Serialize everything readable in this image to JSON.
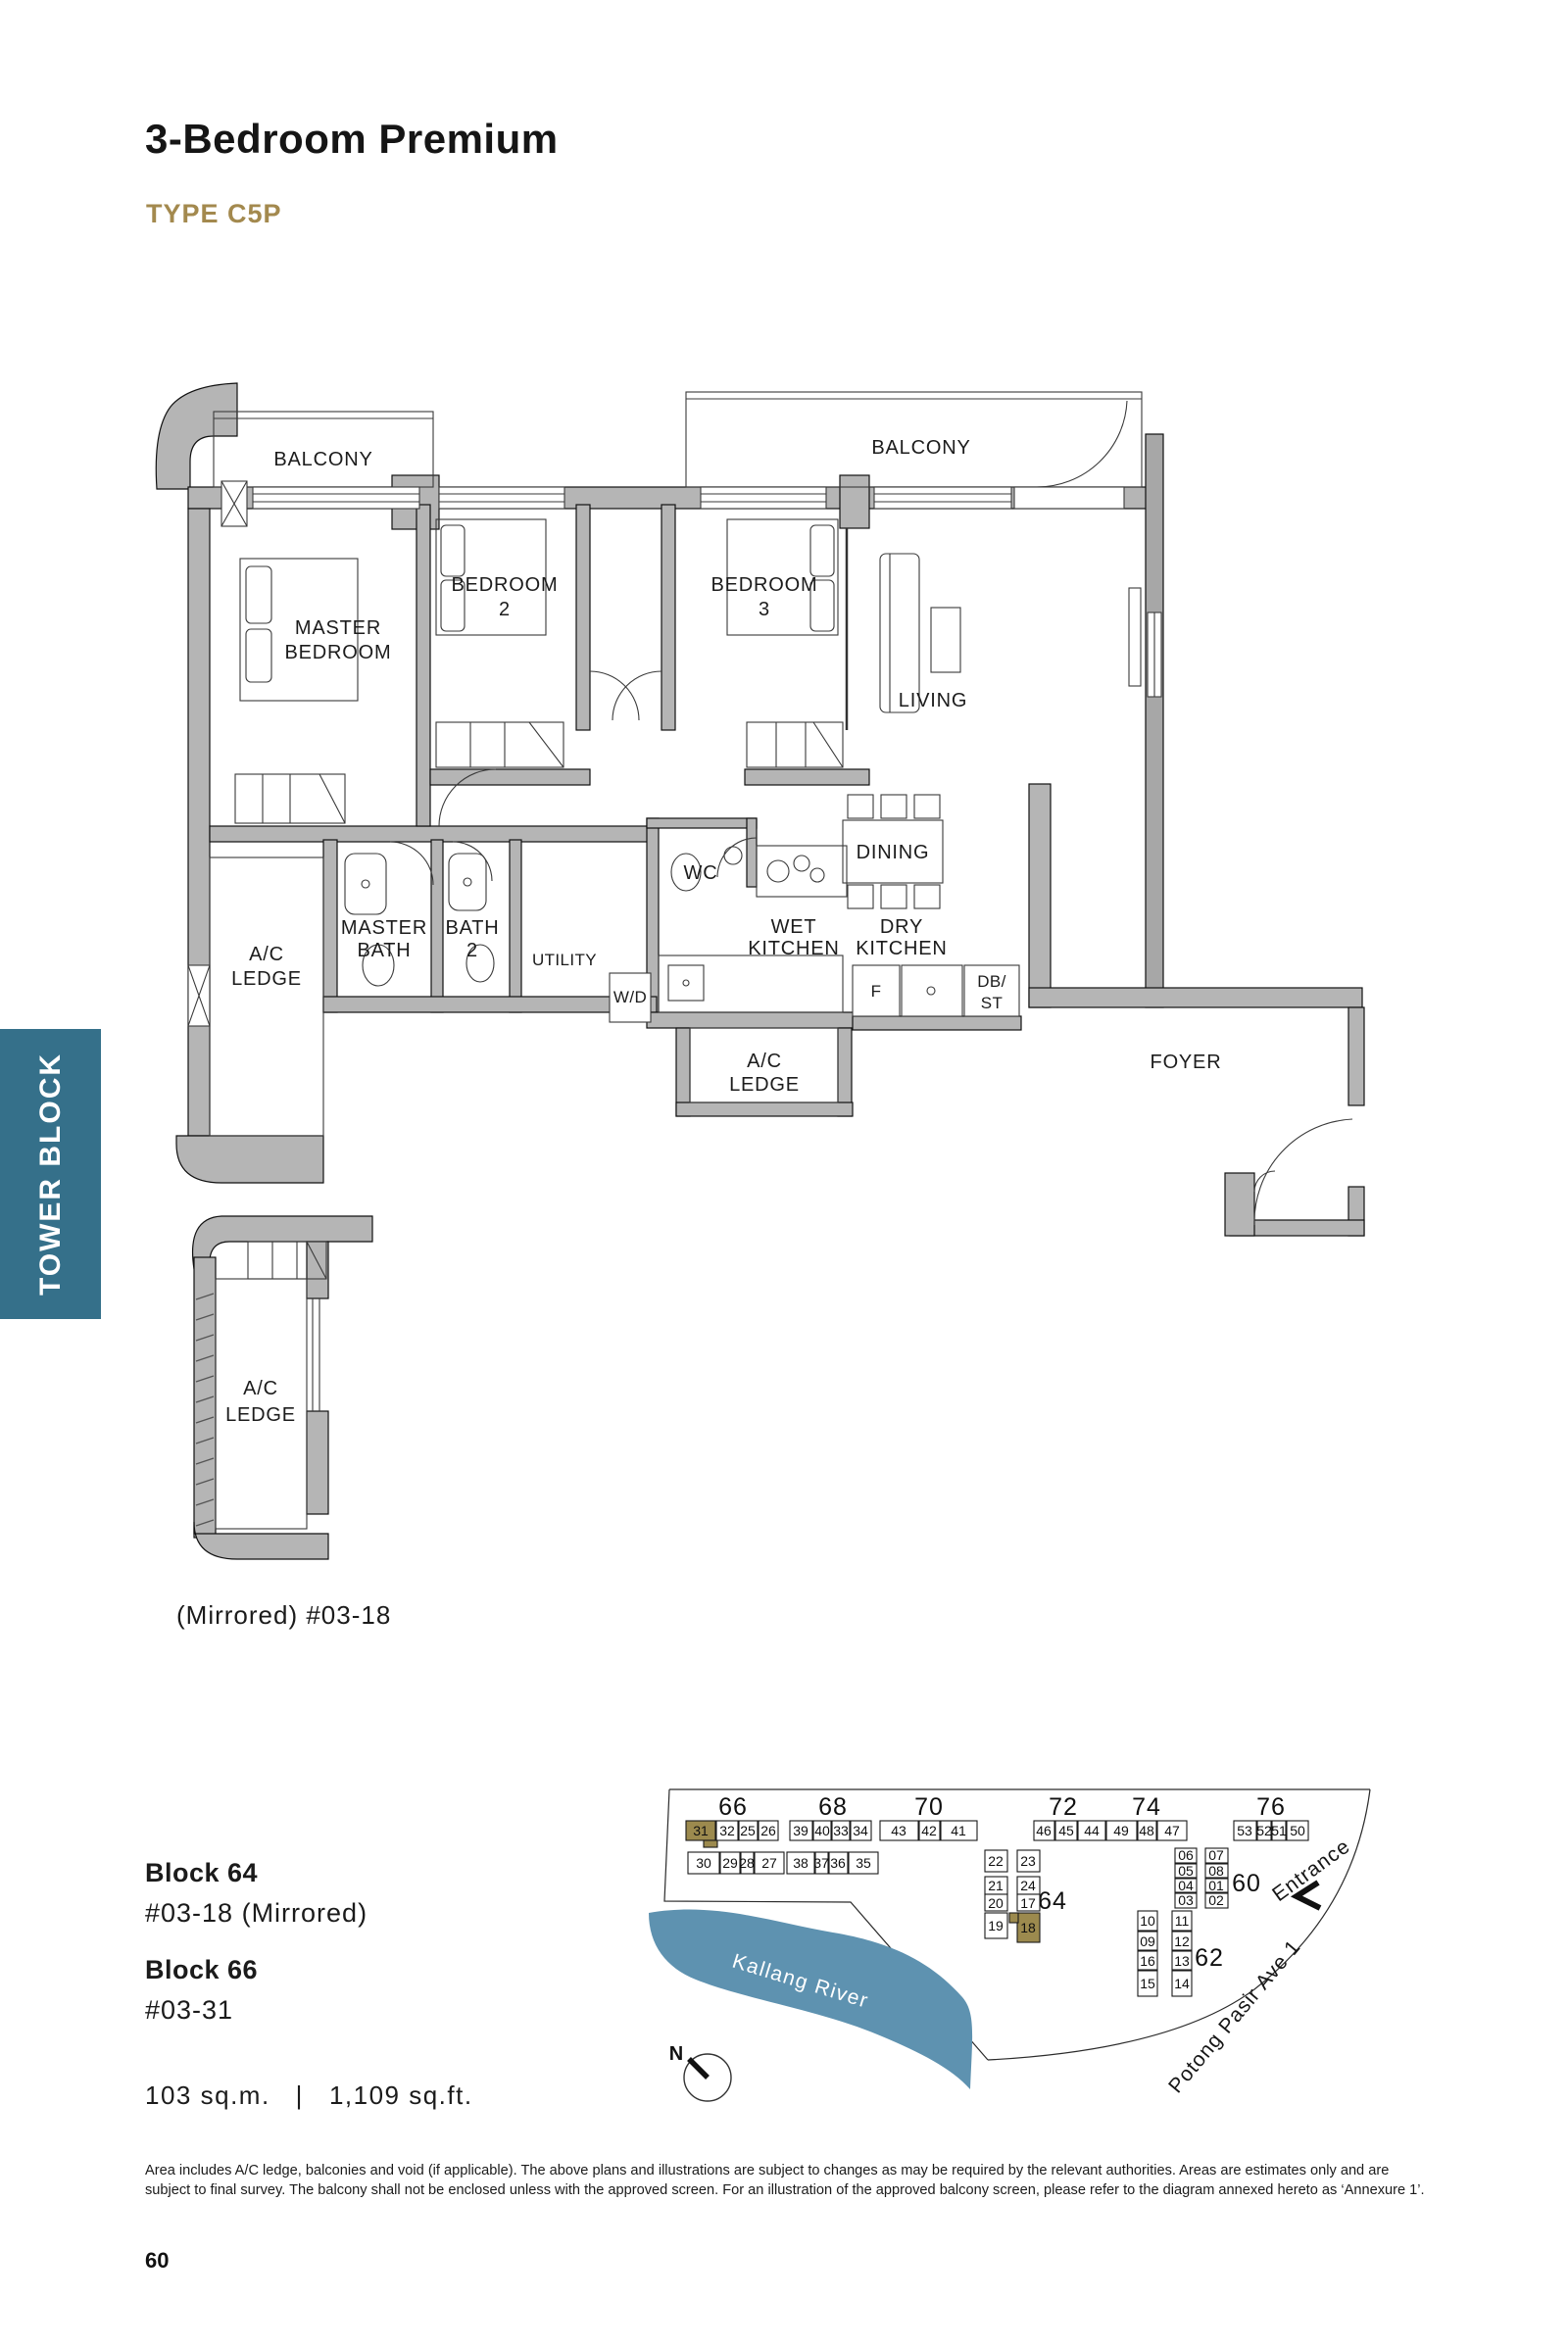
{
  "page": {
    "title": "3-Bedroom Premium",
    "unit_type": "TYPE C5P",
    "side_tab": "TOWER BLOCK",
    "page_number": "60"
  },
  "colors": {
    "tab_teal": "#35708A",
    "type_gold": "#A3894E",
    "unit_highlight_gold": "#9C8A4E",
    "river_blue": "#5E92B0",
    "wall_gray": "#B5B5B5"
  },
  "floorplan": {
    "balcony_left": "BALCONY",
    "balcony_right": "BALCONY",
    "master_bedroom_l1": "MASTER",
    "master_bedroom_l2": "BEDROOM",
    "bedroom2_l1": "BEDROOM",
    "bedroom2_l2": "2",
    "bedroom3_l1": "BEDROOM",
    "bedroom3_l2": "3",
    "living": "LIVING",
    "dining": "DINING",
    "wc": "WC",
    "wet_kitchen_l1": "WET",
    "wet_kitchen_l2": "KITCHEN",
    "dry_kitchen_l1": "DRY",
    "dry_kitchen_l2": "KITCHEN",
    "master_bath_l1": "MASTER",
    "master_bath_l2": "BATH",
    "bath2_l1": "BATH",
    "bath2_l2": "2",
    "utility": "UTILITY",
    "wd": "W/D",
    "fridge": "F",
    "db_st_l1": "DB/",
    "db_st_l2": "ST",
    "foyer": "FOYER",
    "ac_ledge_left_l1": "A/C",
    "ac_ledge_left_l2": "LEDGE",
    "ac_ledge_mid_l1": "A/C",
    "ac_ledge_mid_l2": "LEDGE",
    "ac_ledge_low_l1": "A/C",
    "ac_ledge_low_l2": "LEDGE",
    "mirrored_caption": "(Mirrored) #03-18"
  },
  "unit_info": {
    "block64_label": "Block 64",
    "block64_unit": "#03-18 (Mirrored)",
    "block66_label": "Block 66",
    "block66_unit": "#03-31",
    "area_sqm": "103 sq.m.",
    "area_divider": "|",
    "area_sqft": "1,109 sq.ft."
  },
  "siteplan": {
    "labels": {
      "b66": "66",
      "b68": "68",
      "b70": "70",
      "b72": "72",
      "b74": "74",
      "b76": "76",
      "b64": "64",
      "b60": "60",
      "b62": "62"
    },
    "b66_top": [
      "31",
      "32",
      "25",
      "26"
    ],
    "b66_bot": [
      "30",
      "29",
      "28",
      "27"
    ],
    "b68_top": [
      "39",
      "40",
      "33",
      "34"
    ],
    "b68_bot": [
      "38",
      "37",
      "36",
      "35"
    ],
    "b70": [
      "43",
      "42",
      "41"
    ],
    "b72": [
      "46",
      "45",
      "44"
    ],
    "b74": [
      "49",
      "48",
      "47"
    ],
    "b76": [
      "53",
      "52",
      "51",
      "50"
    ],
    "b64_left": [
      "22",
      "21",
      "20",
      "19"
    ],
    "b64_right": [
      "23",
      "24",
      "17",
      "18"
    ],
    "b60_left": [
      "06",
      "05",
      "04",
      "03"
    ],
    "b60_right": [
      "07",
      "08",
      "01",
      "02"
    ],
    "b62_left": [
      "10",
      "09",
      "16",
      "15"
    ],
    "b62_right": [
      "11",
      "12",
      "13",
      "14"
    ],
    "river": "Kallang River",
    "road": "Potong Pasir Ave 1",
    "entrance": "Entrance",
    "north": "N"
  },
  "footer": {
    "disclaimer_l1": "Area includes A/C ledge, balconies and void (if applicable). The above plans and illustrations are subject to changes as may be required by the relevant authorities. Areas are estimates only and are",
    "disclaimer_l2": "subject to final survey. The balcony shall not be enclosed unless with the approved screen. For an illustration of the approved balcony screen, please refer to the diagram annexed hereto as ‘Annexure 1’."
  }
}
